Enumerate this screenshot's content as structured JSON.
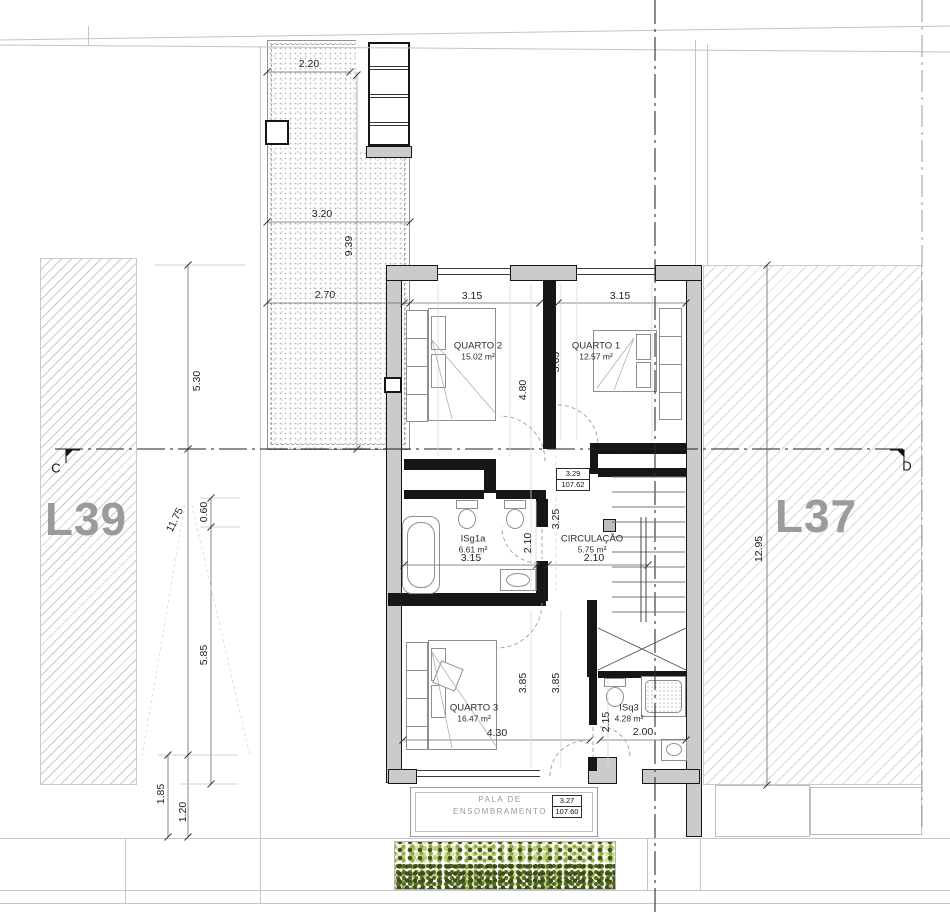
{
  "site": {
    "lot_left": "L39",
    "lot_right": "L37",
    "section_left": "C",
    "section_right": "D"
  },
  "rooms": {
    "quarto1": {
      "name": "QUARTO 1",
      "area": "12.57 m²"
    },
    "quarto2": {
      "name": "QUARTO 2",
      "area": "15.02 m²"
    },
    "quarto3": {
      "name": "QUARTO 3",
      "area": "16.47 m²"
    },
    "isg1a": {
      "name": "ISg1a",
      "area": "6.61 m²"
    },
    "circulacao": {
      "name": "CIRCULAÇÃO",
      "area": "5.75 m²"
    },
    "isq3": {
      "name": "ISq3",
      "area": "4.28 m²"
    }
  },
  "levels": {
    "upper": {
      "value": "3.29",
      "elevation": "107.62"
    },
    "canopy": {
      "value": "3.27",
      "elevation": "107.60"
    }
  },
  "annotations": {
    "canopy_line1": "PALA DE",
    "canopy_line2": "ENSOMBRAMENTO"
  },
  "dims": {
    "terrace_top": "2.20",
    "terrace_mid": "3.20",
    "terrace_height": "9.39",
    "terrace_low": "2.70",
    "quarto2_width": "3.15",
    "quarto1_width": "3.15",
    "quarto2_depth": "4.80",
    "quarto1_depth": "3.65",
    "landing_depth": "3.25",
    "isg1a_depth": "2.10",
    "isg1a_width": "3.15",
    "circulacao_width": "2.10",
    "quarto3_depth_a": "3.85",
    "quarto3_depth_b": "3.85",
    "quarto3_width": "4.30",
    "isq3_depth": "2.15",
    "isq3_width": "2.00",
    "left_upper": "5.30",
    "left_total": "11.75",
    "left_small": "0.60",
    "left_lower": "5.85",
    "left_bottom_a": "1.85",
    "left_bottom_b": "1.20",
    "right_total": "12.95"
  },
  "colors": {
    "wall-fill": "#cbcbcb",
    "site-line": "#c6c6c6",
    "lot-label": "#9b9b9b",
    "dim-text": "#1f1f1f",
    "hedge-light": "#b9cf73",
    "hedge-mid": "#8fae45",
    "hedge-dark": "#42511f"
  }
}
